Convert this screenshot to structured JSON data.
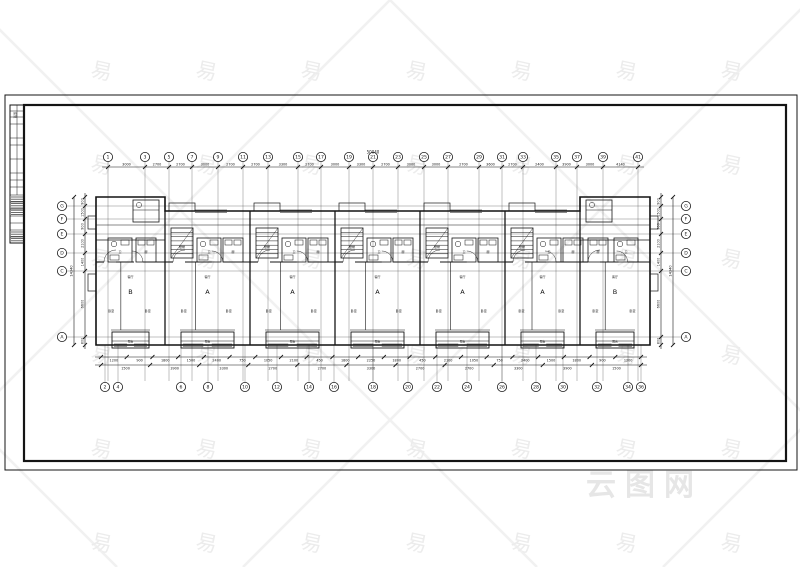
{
  "watermark": {
    "glyph": "易",
    "logo": "云图网",
    "glyph_color": "#ececec",
    "line_color": "#f1f1f1",
    "logo_color": "#e6e6e6",
    "cols": [
      100,
      205,
      310,
      415,
      520,
      625,
      730
    ],
    "rows": [
      78,
      172,
      266,
      362,
      456,
      550
    ]
  },
  "frame": {
    "outer": [
      5,
      95,
      792,
      375
    ],
    "inner": [
      24,
      105,
      762,
      356
    ],
    "color": "#141414"
  },
  "title_block": {
    "x": 10,
    "y": 105,
    "w": 14,
    "h": 138,
    "row_ys": [
      111,
      117,
      124,
      138,
      145,
      159,
      173,
      180,
      187,
      195,
      202,
      209,
      216,
      223,
      230,
      237
    ],
    "divider_x": 17,
    "divider_y_end": 195,
    "hatch_bands": [
      [
        196,
        216
      ],
      [
        231,
        242
      ]
    ],
    "vertical_text": "建施"
  },
  "axes": {
    "top": {
      "bubble_y": 157,
      "labels": [
        "1",
        "3",
        "5",
        "7",
        "9",
        "11",
        "13",
        "15",
        "17",
        "19",
        "21",
        "23",
        "25",
        "27",
        "29",
        "31",
        "33",
        "35",
        "37",
        "39",
        "41"
      ],
      "x": [
        108,
        145,
        169,
        192,
        218,
        243,
        268,
        298,
        321,
        349,
        373,
        398,
        424,
        448,
        479,
        502,
        523,
        556,
        577,
        603,
        638
      ]
    },
    "bottom": {
      "bubble_y": 387,
      "labels": [
        "2",
        "4",
        "6",
        "8",
        "10",
        "12",
        "14",
        "16",
        "18",
        "20",
        "22",
        "24",
        "26",
        "28",
        "30",
        "32",
        "34",
        "36"
      ],
      "x": [
        105,
        118,
        181,
        208,
        245,
        277,
        309,
        334,
        373,
        408,
        437,
        467,
        502,
        536,
        563,
        597,
        628,
        641
      ]
    },
    "left": {
      "bubble_x": 62,
      "labels": [
        "G",
        "F",
        "E",
        "D",
        "C",
        "A"
      ],
      "y": [
        206,
        219,
        234,
        253,
        271,
        337
      ]
    },
    "right": {
      "bubble_x": 686,
      "labels": [
        "G",
        "F",
        "E",
        "D",
        "C",
        "A"
      ],
      "y": [
        206,
        219,
        234,
        253,
        271,
        337
      ]
    }
  },
  "dimensions": {
    "span": {
      "x1": 101,
      "x2": 641,
      "y1": 197,
      "y2": 345
    },
    "top": {
      "line_y": 167,
      "total": "50040",
      "values": [
        "3000",
        "2700",
        "2700",
        "3000",
        "2700",
        "2700",
        "3300",
        "2700",
        "3000",
        "3300",
        "2700",
        "3000",
        "3000",
        "2700",
        "3600",
        "2700",
        "2400",
        "3900",
        "3000",
        "4140"
      ]
    },
    "bottom_upper": {
      "line_y": 357,
      "values": [
        "1200",
        "900",
        "1800",
        "1500",
        "2400",
        "750",
        "1050",
        "2100",
        "450",
        "1800",
        "2250",
        "1800",
        "450",
        "2100",
        "1050",
        "750",
        "2400",
        "1500",
        "1800",
        "900",
        "1200"
      ]
    },
    "bottom_lower": {
      "line_y": 365,
      "values": [
        "1500",
        "3900",
        "3300",
        "2700",
        "2700",
        "3300",
        "2700",
        "2700",
        "3300",
        "3900",
        "1500"
      ]
    },
    "left": {
      "line_x": 85,
      "total": "14340",
      "total_x": 74,
      "values": [
        "900",
        "1500",
        "900",
        "2100",
        "1400",
        "6600",
        "800"
      ]
    },
    "right": {
      "line_x": 661,
      "total": "14340",
      "total_x": 673,
      "values": [
        "900",
        "1500",
        "900",
        "2100",
        "1400",
        "6600",
        "800"
      ]
    }
  },
  "plan": {
    "outline": {
      "x1": 96,
      "x2": 650,
      "y_top_end": 197,
      "y_top_mid": 211,
      "y_bottom": 345,
      "end_w": 69
    },
    "bays": [
      {
        "x": 96,
        "w": 69,
        "type": "end",
        "label": "B"
      },
      {
        "x": 165,
        "w": 85,
        "type": "mid",
        "label": "A"
      },
      {
        "x": 250,
        "w": 85,
        "type": "mid",
        "label": "A"
      },
      {
        "x": 335,
        "w": 85,
        "type": "mid",
        "label": "A"
      },
      {
        "x": 420,
        "w": 85,
        "type": "mid",
        "label": "A"
      },
      {
        "x": 505,
        "w": 75,
        "type": "mid",
        "label": "A"
      },
      {
        "x": 580,
        "w": 70,
        "type": "end",
        "label": "B"
      }
    ],
    "room_labels": {
      "stair": "楼梯",
      "bath": "卫",
      "kitchen": "厨",
      "living": "客厅",
      "bed": "卧室",
      "balcony": "阳台"
    }
  }
}
